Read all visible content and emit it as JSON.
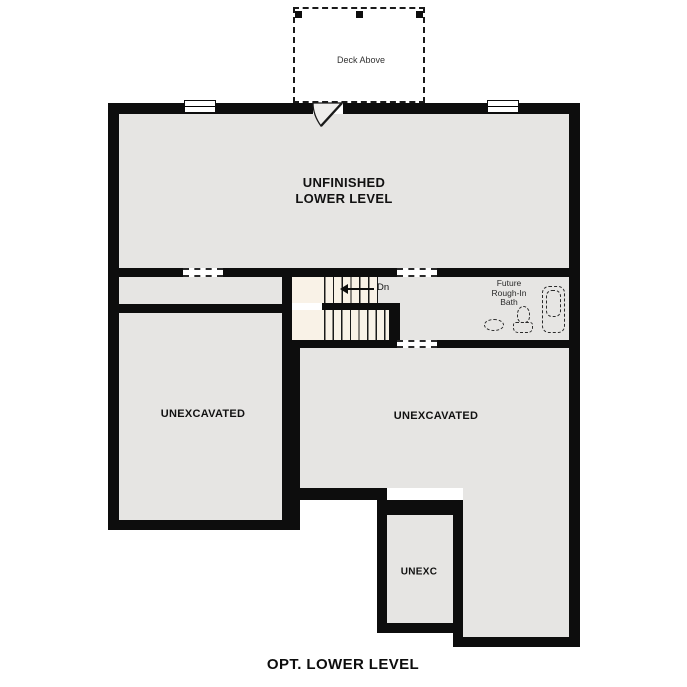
{
  "plan_title": "OPT. LOWER LEVEL",
  "deck": {
    "label": "Deck Above"
  },
  "rooms": {
    "unfinished": {
      "line1": "UNFINISHED",
      "line2": "LOWER LEVEL"
    },
    "unexcavated_left": {
      "label": "UNEXCAVATED"
    },
    "unexcavated_right": {
      "label": "UNEXCAVATED"
    },
    "unexc_small": {
      "label": "UNEXC"
    },
    "bath": {
      "line1": "Future",
      "line2": "Rough-In",
      "line3": "Bath"
    }
  },
  "stairs": {
    "direction_label": "Dn"
  },
  "colors": {
    "wall": "#0d0d0d",
    "room_fill": "#e6e5e3",
    "stair_fill": "#f9f2e7",
    "background": "#ffffff"
  }
}
